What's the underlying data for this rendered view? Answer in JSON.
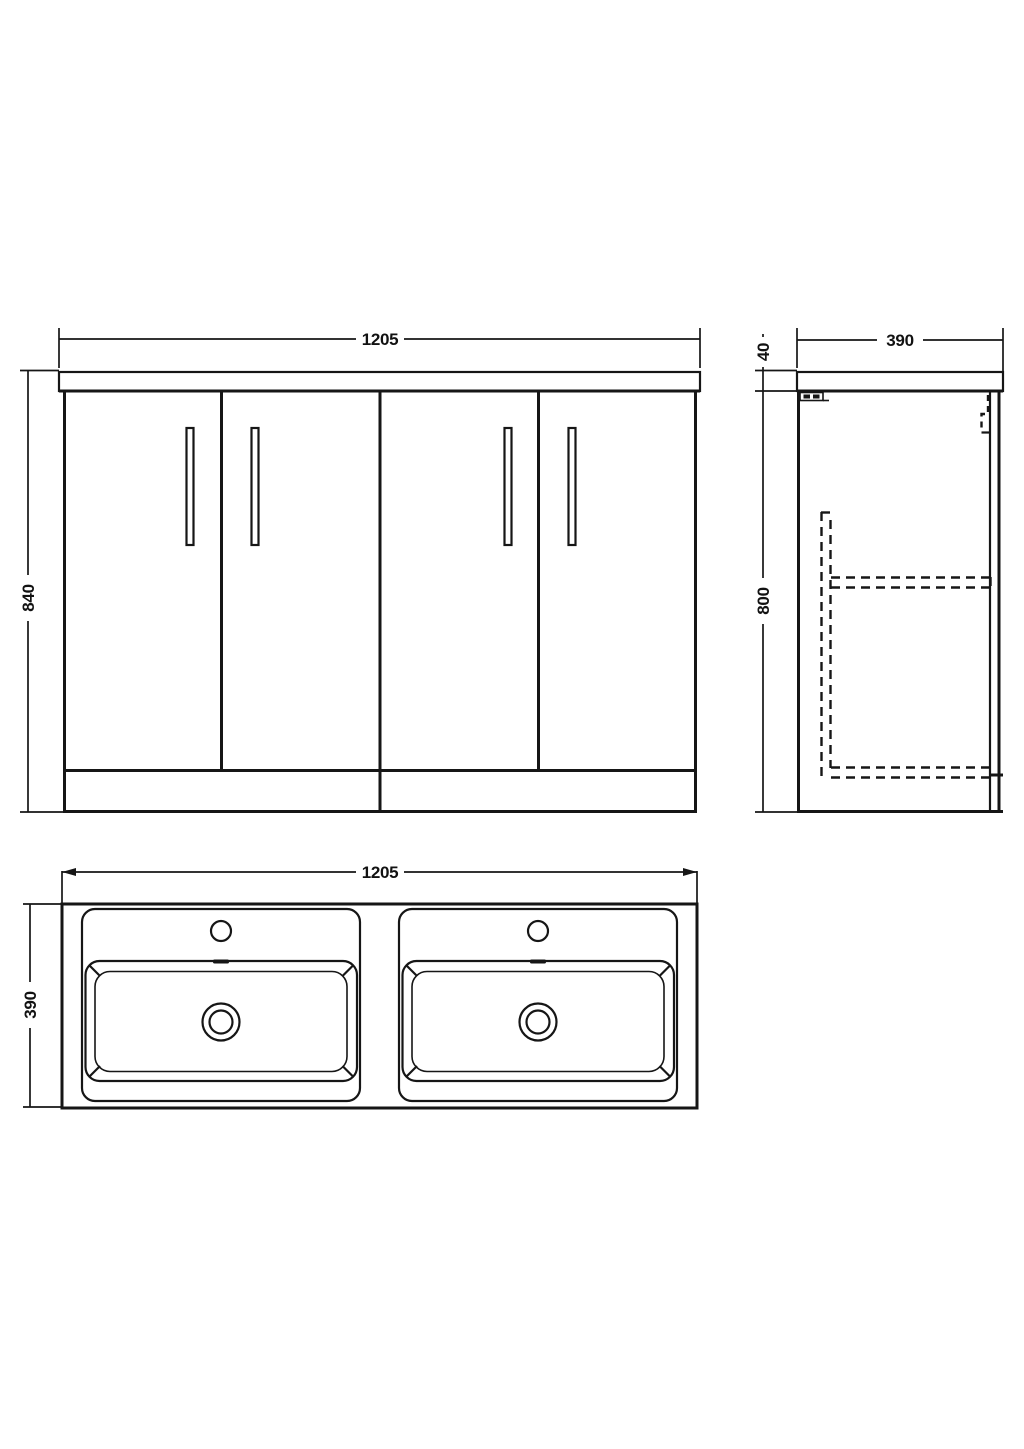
{
  "drawing": {
    "kind": "bathroom vanity unit technical drawing",
    "views": {
      "front": {
        "label": "front-elevation",
        "width_mm": "1205",
        "height_mm": "840",
        "door_count": 4,
        "handle_count": 4
      },
      "side": {
        "label": "side-elevation",
        "depth_mm": "390",
        "worktop_thickness_mm": "40",
        "carcass_height_mm": "800"
      },
      "plan": {
        "label": "plan-view",
        "width_mm": "1205",
        "depth_mm": "390",
        "basin_count": 2
      }
    },
    "colors": {
      "line": "#161616",
      "background": "#ffffff"
    }
  }
}
